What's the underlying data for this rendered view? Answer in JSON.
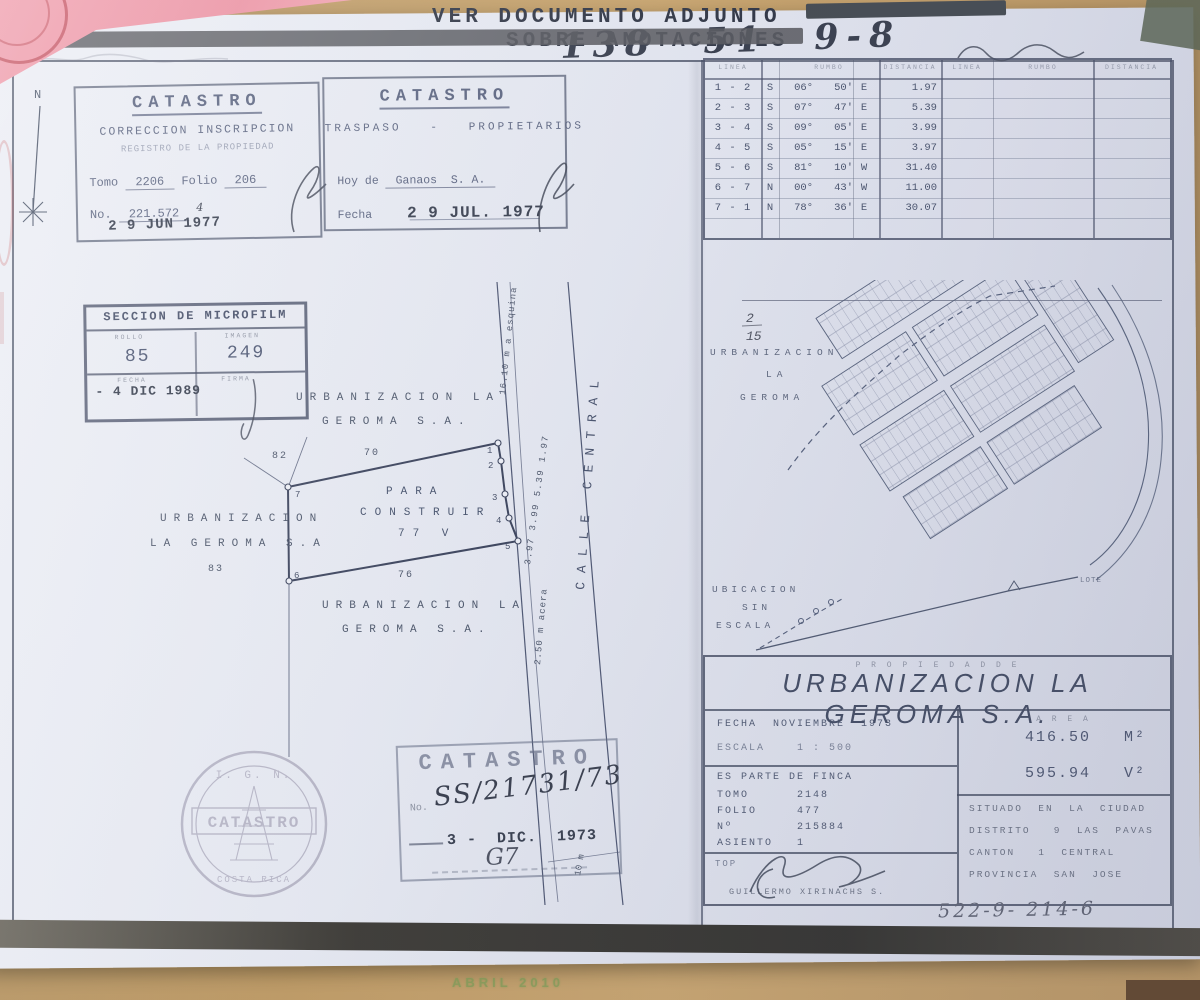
{
  "header": {
    "line1": "VER DOCUMENTO ADJUNTO",
    "line2": "SOBRE ANOTACIONES",
    "handwritten_ref": "138 51 9-8"
  },
  "north": {
    "label": "N"
  },
  "stamp_correccion": {
    "title": "CATASTRO",
    "subtitle": "CORRECCION INSCRIPCION",
    "subtitle2": "REGISTRO DE LA PROPIEDAD",
    "tomo_label": "Tomo",
    "tomo_value": "2206",
    "folio_label": "Folio",
    "folio_value": "206",
    "no_label": "No.",
    "no_value": "221.572",
    "no_suffix": "4",
    "date_stamp": "2 9 JUN 1977"
  },
  "stamp_traspaso": {
    "title": "CATASTRO",
    "subtitle": "TRASPASO   -   PROPIETARIOS",
    "owner_label": "Hoy de",
    "owner_value": "Ganaos  S. A.",
    "fecha_label": "Fecha",
    "date_stamp": "2 9 JUL. 1977"
  },
  "survey_table": {
    "col_linea": "LINEA",
    "col_rumbo": "RUMBO",
    "col_distancia": "DISTANCIA",
    "rows": [
      {
        "linea": "1 - 2",
        "ns": "S",
        "deg": "06°",
        "min": "50'",
        "ew": "E",
        "dist": "1.97"
      },
      {
        "linea": "2 - 3",
        "ns": "S",
        "deg": "07°",
        "min": "47'",
        "ew": "E",
        "dist": "5.39"
      },
      {
        "linea": "3 - 4",
        "ns": "S",
        "deg": "09°",
        "min": "05'",
        "ew": "E",
        "dist": "3.99"
      },
      {
        "linea": "4 - 5",
        "ns": "S",
        "deg": "05°",
        "min": "15'",
        "ew": "E",
        "dist": "3.97"
      },
      {
        "linea": "5 - 6",
        "ns": "S",
        "deg": "81°",
        "min": "10'",
        "ew": "W",
        "dist": "31.40"
      },
      {
        "linea": "6 - 7",
        "ns": "N",
        "deg": "00°",
        "min": "43'",
        "ew": "W",
        "dist": "11.00"
      },
      {
        "linea": "7 - 1",
        "ns": "N",
        "deg": "78°",
        "min": "36'",
        "ew": "E",
        "dist": "30.07"
      }
    ]
  },
  "stamp_microfilm": {
    "title": "SECCION DE MICROFILM",
    "rollo_label": "ROLLO",
    "rollo_value": "85",
    "imagen_label": "IMAGEN",
    "imagen_value": "249",
    "fecha_label": "FECHA",
    "fecha_value": "- 4 DIC 1989",
    "firma_label": "FIRMA"
  },
  "plot": {
    "neighbor_top1": "URBANIZACION LA",
    "neighbor_top2": "GEROMA S.A.",
    "neighbor_left1": "URBANIZACION",
    "neighbor_left2": "LA GEROMA S.A",
    "neighbor_left_lot": "83",
    "neighbor_bottom1": "URBANIZACION LA",
    "neighbor_bottom2": "GEROMA S.A.",
    "lot_82": "82",
    "len_top": "70",
    "len_bottom": "76",
    "label_line1": "PARA",
    "label_line2": "CONSTRUIR",
    "label_line3": "77 V",
    "corner_1": "1",
    "corner_2": "2",
    "corner_3": "3",
    "corner_4": "4",
    "corner_5": "5",
    "corner_6": "6",
    "corner_7": "7",
    "edge_dists": "3.97  3.99  5.39  1.97",
    "to_corner": "16.10 m a esquina",
    "acera": "2.50 m acera",
    "calle": "CALLE CENTRAL",
    "calle_width": "10 m"
  },
  "map": {
    "hand_top": "2",
    "hand_bottom": "15",
    "name1": "URBANIZACION",
    "name2": "LA",
    "name3": "GEROMA",
    "ubicacion1": "UBICACION",
    "ubicacion2": "SIN",
    "ubicacion3": "ESCALA",
    "lote": "LOTE"
  },
  "title_block": {
    "propiedad_de": "P R O P I E D A D   D E",
    "owner": "URBANIZACION LA GEROMA S.A.",
    "fecha": "FECHA  NOVIEMBRE  1973",
    "escala": "ESCALA    1 : 500",
    "area_label": "A R E A",
    "area_m": "416.50   M²",
    "area_v": "595.94   V²",
    "finca": "ES PARTE DE FINCA",
    "tomo": "TOMO      2148",
    "folio": "FOLIO     477",
    "numero": "Nº        215884",
    "asiento": "ASIENTO   1",
    "top_label": "TOP",
    "surveyor": "GUILLERMO  XIRINACHS  S.",
    "situado1": "SITUADO  EN  LA  CIUDAD",
    "situado2": "DISTRITO   9  LAS  PAVAS",
    "situado3": "CANTON   1  CENTRAL",
    "situado4": "PROVINCIA  SAN  JOSE"
  },
  "stamp_catastro73": {
    "title": "CATASTRO",
    "no_label": "No.",
    "no_value": "SS/21731/73",
    "date_stamp": "3 -  DIC.  1973",
    "note": "G7"
  },
  "seal": {
    "org": "I. G. N.",
    "name": "CATASTRO",
    "country": "COSTA RICA"
  },
  "footer": {
    "handwritten_ref": "522-9-  214-6",
    "desk_text": "ABRIL 2010"
  }
}
